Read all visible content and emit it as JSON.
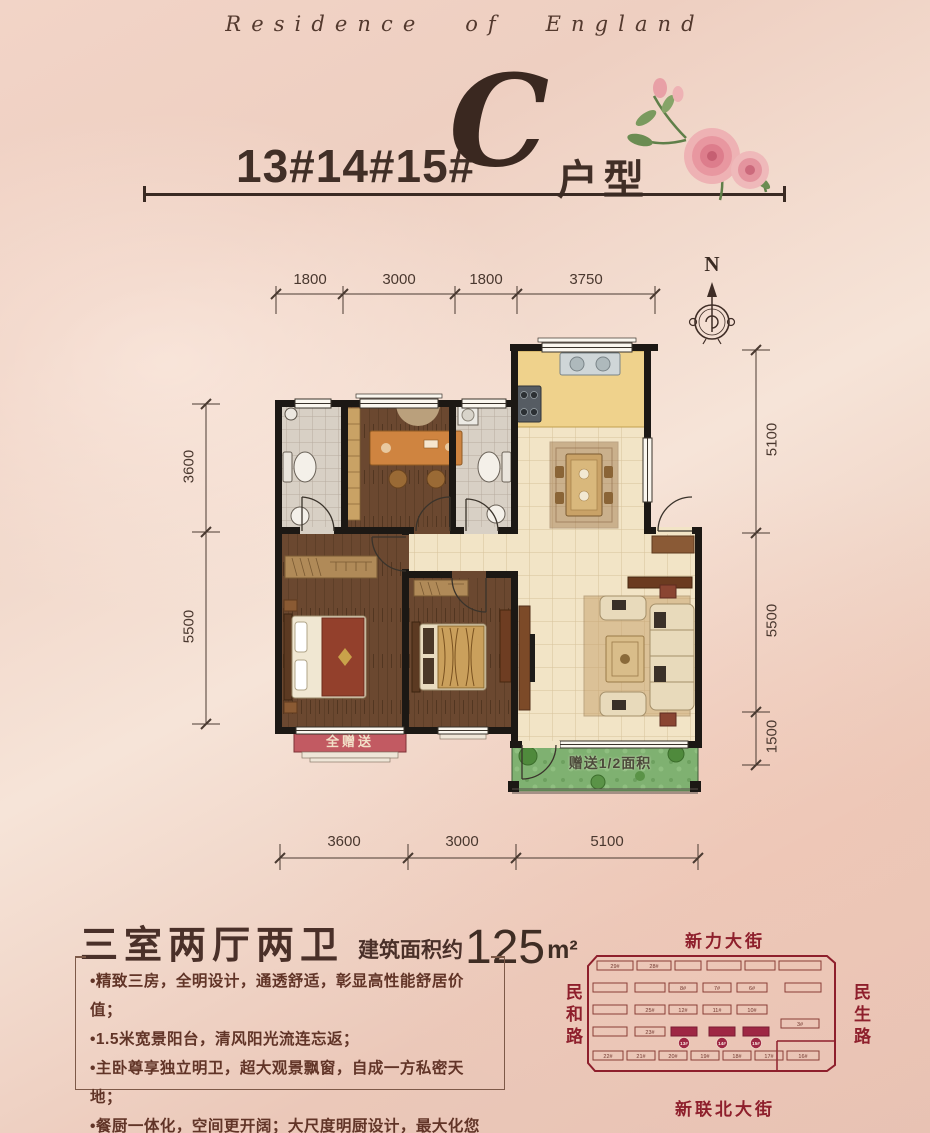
{
  "brand": "Residence of England",
  "title": {
    "buildings": "13#14#15#",
    "unit_letter": "C",
    "unit_label": "户型"
  },
  "compass": {
    "north": "N"
  },
  "dims": {
    "top": [
      "1800",
      "3000",
      "1800",
      "3750"
    ],
    "left": [
      "3600",
      "5500"
    ],
    "right": [
      "5100",
      "5500",
      "1500"
    ],
    "bottom": [
      "3600",
      "3000",
      "5100"
    ]
  },
  "plan_labels": {
    "master_bay": "全赠送",
    "balcony_gift": "赠送1/2面积"
  },
  "summary": {
    "rooms": "三室两厅两卫",
    "area_prefix": "建筑面积约",
    "area_number": "125",
    "area_unit": "m²"
  },
  "features": [
    "•精致三房，全明设计，通透舒适，彰显高性能舒居价值；",
    "•1.5米宽景阳台，清风阳光流连忘返；",
    "•主卧尊享独立明卫，超大观景飘窗，自成一方私密天地；",
    "•餐厨一体化，空间更开阔；大尺度明厨设计，最大化您的生活享受。"
  ],
  "sitemap": {
    "street_top": "新力大街",
    "street_left": "民和路",
    "street_right": "民生路",
    "street_bottom": "新联北大街",
    "buildings": [
      {
        "x": 12,
        "y": 8,
        "w": 36,
        "h": 9,
        "label": "29#"
      },
      {
        "x": 52,
        "y": 8,
        "w": 34,
        "h": 9,
        "label": "28#"
      },
      {
        "x": 90,
        "y": 8,
        "w": 26,
        "h": 9,
        "label": ""
      },
      {
        "x": 122,
        "y": 8,
        "w": 34,
        "h": 9,
        "label": ""
      },
      {
        "x": 160,
        "y": 8,
        "w": 30,
        "h": 9,
        "label": ""
      },
      {
        "x": 194,
        "y": 8,
        "w": 42,
        "h": 9,
        "label": ""
      },
      {
        "x": 8,
        "y": 30,
        "w": 34,
        "h": 9,
        "label": ""
      },
      {
        "x": 50,
        "y": 30,
        "w": 30,
        "h": 9,
        "label": ""
      },
      {
        "x": 84,
        "y": 30,
        "w": 28,
        "h": 9,
        "label": "8#"
      },
      {
        "x": 118,
        "y": 30,
        "w": 28,
        "h": 9,
        "label": "7#"
      },
      {
        "x": 152,
        "y": 30,
        "w": 30,
        "h": 9,
        "label": "6#"
      },
      {
        "x": 200,
        "y": 30,
        "w": 36,
        "h": 9,
        "label": ""
      },
      {
        "x": 8,
        "y": 52,
        "w": 34,
        "h": 9,
        "label": ""
      },
      {
        "x": 50,
        "y": 52,
        "w": 30,
        "h": 9,
        "label": "25#"
      },
      {
        "x": 84,
        "y": 52,
        "w": 28,
        "h": 9,
        "label": "12#"
      },
      {
        "x": 118,
        "y": 52,
        "w": 28,
        "h": 9,
        "label": "11#"
      },
      {
        "x": 152,
        "y": 52,
        "w": 30,
        "h": 9,
        "label": "10#"
      },
      {
        "x": 196,
        "y": 66,
        "w": 38,
        "h": 9,
        "label": "3#"
      },
      {
        "x": 8,
        "y": 74,
        "w": 34,
        "h": 9,
        "label": ""
      },
      {
        "x": 50,
        "y": 74,
        "w": 30,
        "h": 9,
        "label": "23#"
      },
      {
        "x": 86,
        "y": 74,
        "w": 26,
        "h": 9,
        "label": "13#",
        "hl": true
      },
      {
        "x": 124,
        "y": 74,
        "w": 26,
        "h": 9,
        "label": "14#",
        "hl": true
      },
      {
        "x": 158,
        "y": 74,
        "w": 26,
        "h": 9,
        "label": "15#",
        "hl": true
      },
      {
        "x": 8,
        "y": 98,
        "w": 30,
        "h": 9,
        "label": "22#"
      },
      {
        "x": 42,
        "y": 98,
        "w": 28,
        "h": 9,
        "label": "21#"
      },
      {
        "x": 74,
        "y": 98,
        "w": 28,
        "h": 9,
        "label": "20#"
      },
      {
        "x": 106,
        "y": 98,
        "w": 28,
        "h": 9,
        "label": "19#"
      },
      {
        "x": 138,
        "y": 98,
        "w": 28,
        "h": 9,
        "label": "18#"
      },
      {
        "x": 170,
        "y": 98,
        "w": 28,
        "h": 9,
        "label": "17#"
      },
      {
        "x": 202,
        "y": 98,
        "w": 32,
        "h": 9,
        "label": "16#"
      }
    ]
  },
  "colors": {
    "accent_brown": "#3f2d26",
    "map_red": "#8e1f2c",
    "wall_black": "#1c1814",
    "balcony_green": "#7fb171",
    "bay_pink": "#c25a62",
    "kitchen_yellow": "#efd28c"
  }
}
